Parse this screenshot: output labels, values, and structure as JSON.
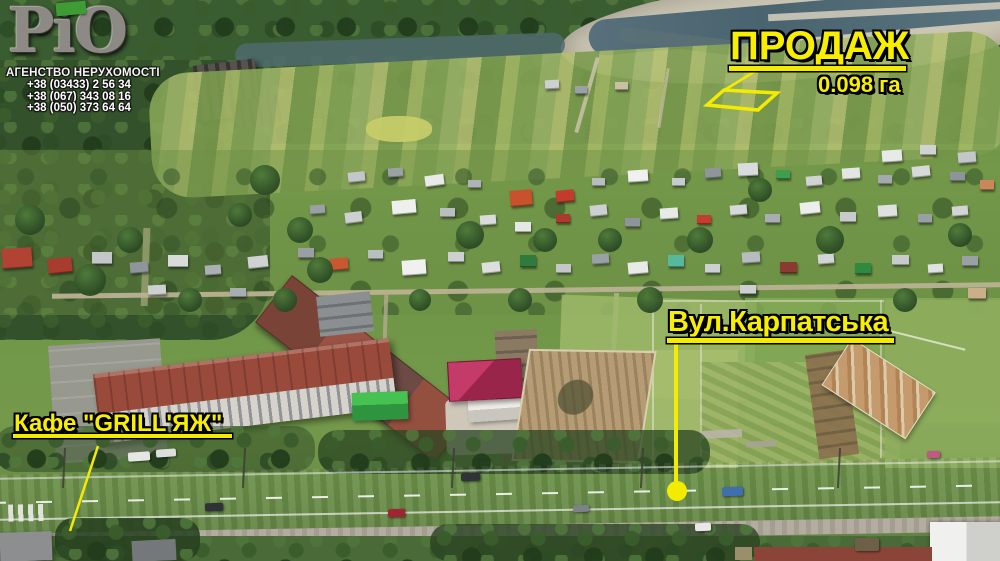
{
  "brand": {
    "name": "РіО",
    "tagline": "АГЕНСТВО НЕРУХОМОСТІ",
    "phones": [
      "+38 (03433) 2 56 34",
      "+38 (067) 343 08 16",
      "+38 (050) 373 64 64"
    ],
    "logo_green": "#3f9c35"
  },
  "annotations": {
    "accent_color": "#f8ef00",
    "outline_color": "#000000",
    "sale": {
      "label": "ПРОДАЖ",
      "area": "0.098 га"
    },
    "street": {
      "label": "Вул.Карпатська"
    },
    "cafe": {
      "label": "Кафе \"GRILL'ЯЖ\""
    }
  }
}
